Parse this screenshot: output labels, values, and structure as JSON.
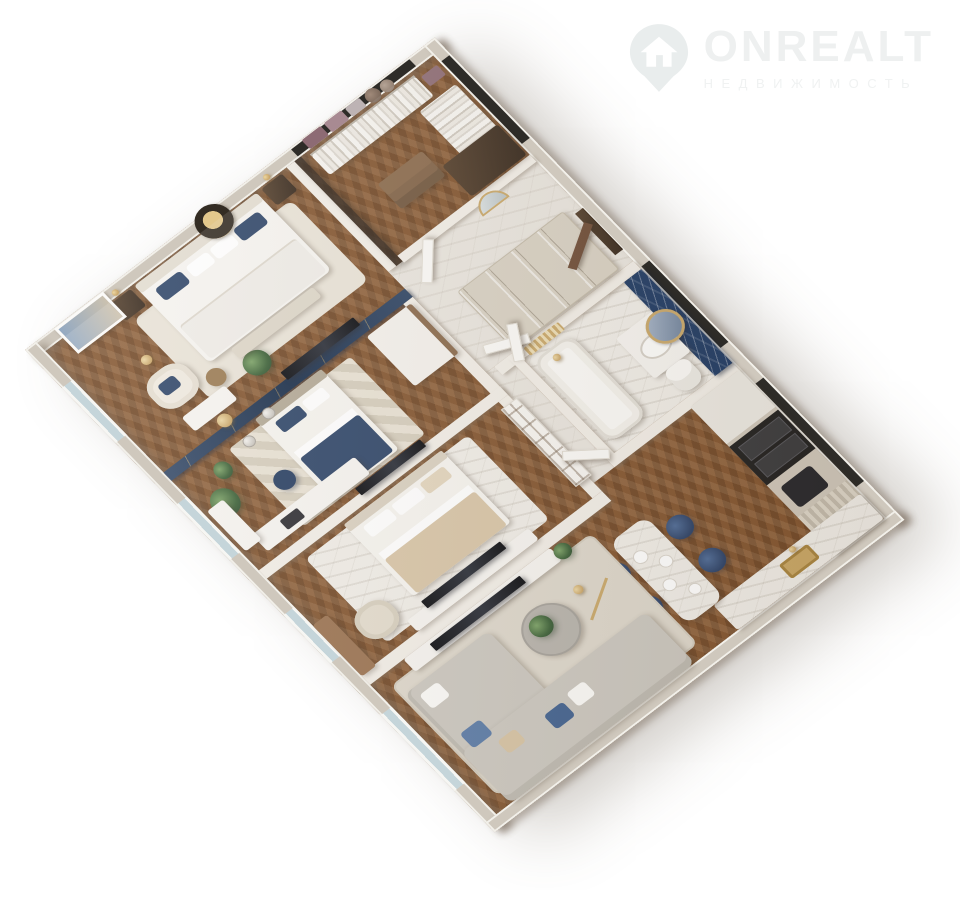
{
  "brand": {
    "name": "ONREALT",
    "tagline": "НЕДВИЖИМОСТЬ",
    "logo_icon": "house-location-pin",
    "watermark_color": "#eef0f0"
  },
  "palette": {
    "background": "#ffffff",
    "exterior_wall": "#cfc8bd",
    "wall_top_rim": "#f2f0ea",
    "interior_wall": "#f2eee7",
    "wood_floor": "#83552f",
    "marble_floor": "#e9e5de",
    "bathroom_marble": "#f0ede7",
    "navy_feature_marble": "#1f3a63",
    "navy_accent_wall": "#1d3557",
    "navy_textile": "#2e4568",
    "soft_blue_cushion": "#5a7aa6",
    "sofa_grey": "#cbc7bf",
    "beige_textile": "#d7c4a6",
    "gold_accent": "#c3a169",
    "dark_wood": "#4d3826",
    "mid_wood": "#8a6a4c",
    "appliance_black": "#201f1e",
    "white_furniture": "#f6f4f0",
    "plant_green": "#3c6137",
    "window_glass": "#c5d5da"
  },
  "floor_plan": {
    "view": "3d-perspective-apartment-render",
    "rooms": [
      {
        "name": "master-bedroom",
        "furniture": [
          "double-bed-white-navy-pillows",
          "dark-nightstands-pair",
          "gold-wall-sconces",
          "round-gold-medallion-art",
          "framed-abstract-picture",
          "cream-armchair",
          "gold-floor-lamp",
          "side-table",
          "vanity-desk",
          "gold-stool",
          "bench",
          "potted-plant",
          "navy-accent-wall-with-tv"
        ]
      },
      {
        "name": "walk-in-closet",
        "furniture": [
          "hanging-clothes-rails",
          "storage-boxes",
          "hat-boxes",
          "drawer-island",
          "dark-wood-wardrobe",
          "smoked-glass-partition"
        ]
      },
      {
        "name": "entrance-hall",
        "furniture": [
          "paneled-built-in-wardrobes",
          "arched-mirror",
          "dark-entry-door"
        ]
      },
      {
        "name": "bathroom",
        "furniture": [
          "navy-marble-feature-wall",
          "round-gold-mirror",
          "white-vanity-sink",
          "bathtub",
          "toilet",
          "gold-towel-radiator"
        ]
      },
      {
        "name": "kitchen",
        "furniture": [
          "tall-cabinet-run",
          "double-black-ovens",
          "black-hob",
          "fluted-cabinet",
          "marble-counter",
          "gold-sink"
        ]
      },
      {
        "name": "dining-area",
        "furniture": [
          "marble-peninsula-table",
          "navy-velvet-chairs-4",
          "table-plates",
          "gold-arc-floor-lamp"
        ]
      },
      {
        "name": "living-room",
        "furniture": [
          "l-shaped-grey-sofa",
          "scatter-cushions-navy-white-beige",
          "round-coffee-table",
          "plant-on-table",
          "tv-console",
          "wall-tv",
          "area-rug",
          "console-plant"
        ]
      },
      {
        "name": "kids-bedroom",
        "furniture": [
          "single-bed-navy-bedding",
          "navy-accent-wall-gold-lines",
          "glass-pendant-globes",
          "chevron-rug",
          "navy-ottoman",
          "desk-with-laptop",
          "window-desk",
          "white-wardrobe",
          "wall-tv",
          "plants"
        ]
      },
      {
        "name": "second-bedroom",
        "furniture": [
          "double-bed-beige-bedding",
          "marble-pattern-rug",
          "beige-armchair",
          "window-desk",
          "media-console",
          "wall-tv",
          "open-shelf-partition"
        ]
      }
    ],
    "windows_sw_wall": 4,
    "glazing_slits_ne_wall": 3
  }
}
